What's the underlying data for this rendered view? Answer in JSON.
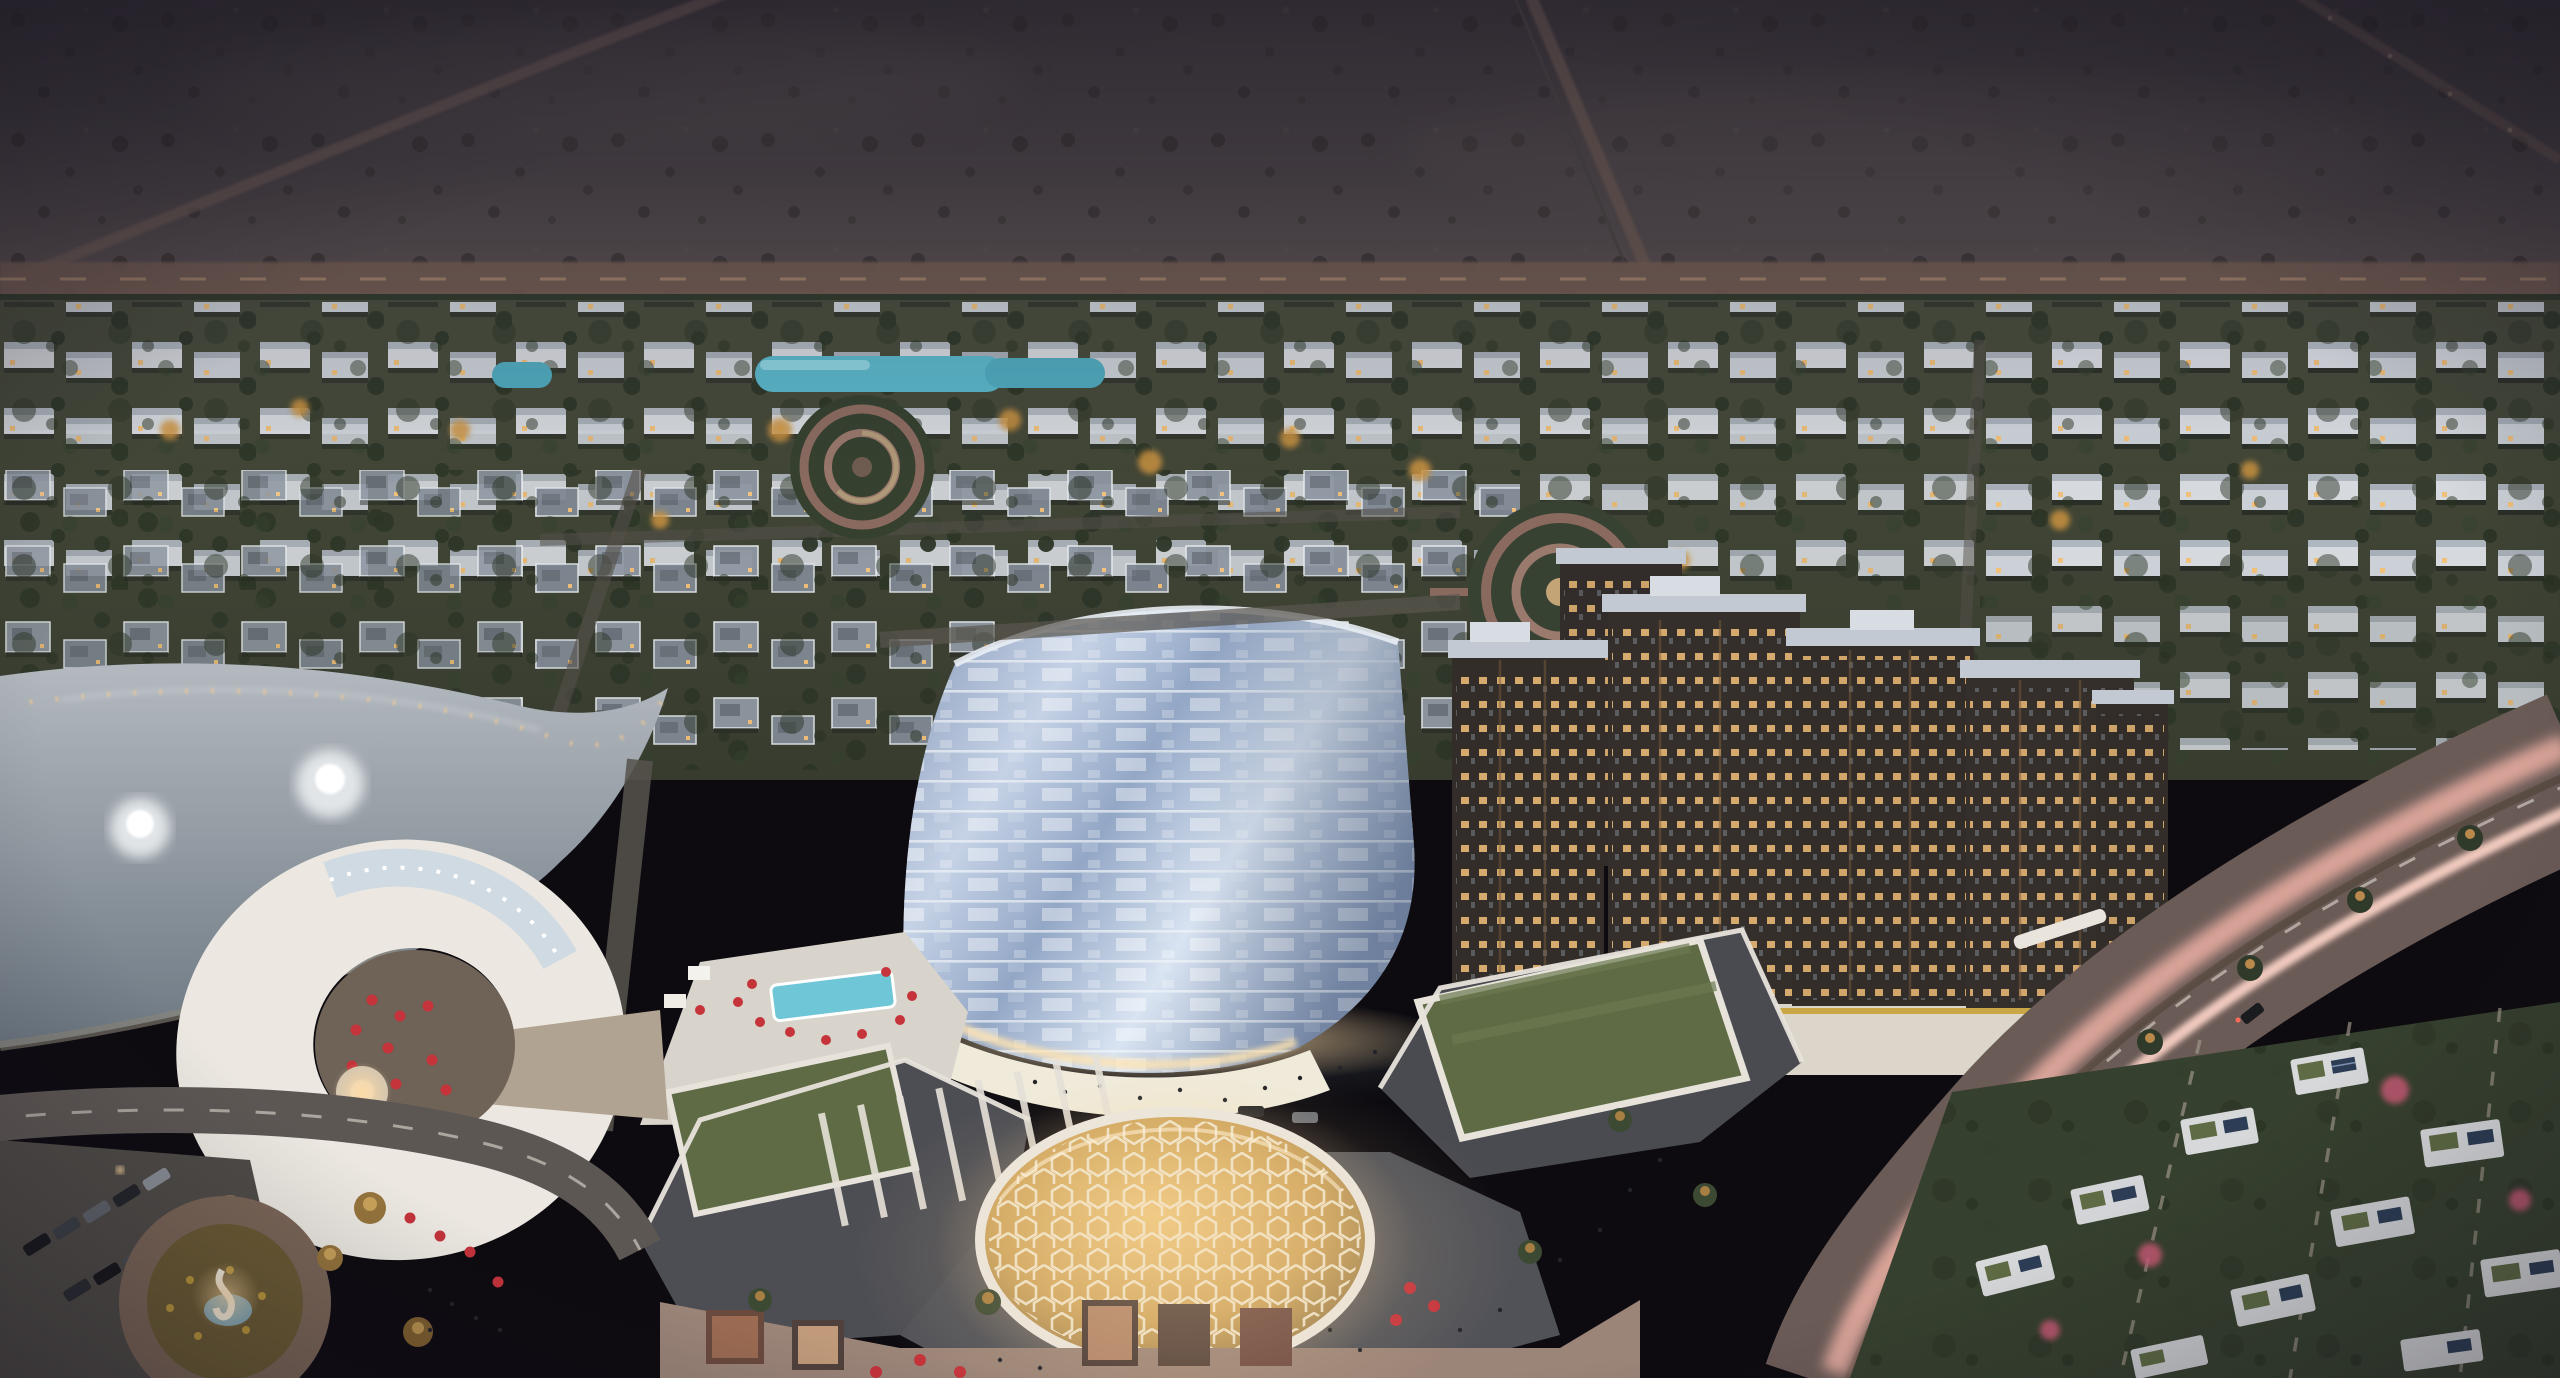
{
  "scene": {
    "type": "aerial-architectural-render",
    "time_of_day": "dusk",
    "setting": "desert master-planned residential community",
    "landmarks": [
      {
        "id": "desert-backdrop",
        "label": "empty desert plain with dirt roads"
      },
      {
        "id": "villa-district",
        "label": "rows of white and grey villas with lit windows"
      },
      {
        "id": "lagoon-pool",
        "label": "turquoise lagoon pool among villas"
      },
      {
        "id": "garden-circles",
        "label": "two circular spiral garden parks"
      },
      {
        "id": "lake",
        "label": "curved lake with two fountains and lit promenade"
      },
      {
        "id": "clubhouse",
        "label": "white C-shaped lakeside clubhouse with red umbrellas"
      },
      {
        "id": "hotel-tower",
        "label": "curved blue-glass hotel tower with lit plaza"
      },
      {
        "id": "pool-deck",
        "label": "hotel pool deck with red loungers"
      },
      {
        "id": "mall-complex",
        "label": "mall with glowing honeycomb dome and green roofs"
      },
      {
        "id": "apartment-complex",
        "label": "dark bronze apartment blocks on lit retail podium"
      },
      {
        "id": "parking-lot",
        "label": "parking lot with cars"
      },
      {
        "id": "roundabout",
        "label": "roundabout with flower bed and sculpture fountain"
      },
      {
        "id": "highway",
        "label": "curved highway with pink car light trails and palm median"
      },
      {
        "id": "townhouse-district",
        "label": "white townhouses with rooftop solar panels"
      }
    ],
    "features": {
      "fountains": 2,
      "garden_circles": 2,
      "domes": 1
    }
  },
  "palette": {
    "sky_top": "#343031",
    "sky_mid": "#454041",
    "horizon_haze": "#665750",
    "desert_speckle": "#26221e",
    "boundary_road": "#6f5a50",
    "villa_band": "#3f4336",
    "villa_white": "#d8dce1",
    "villa_grey": "#8e97a2",
    "tree_dark": "#2c3527",
    "tree_lit": "#c9923f",
    "lagoon": "#58b5c7",
    "lake_top": "#b3b9bf",
    "lake_deep": "#6d7882",
    "shore_light": "#f6c98e",
    "clubhouse_white": "#ece8e1",
    "terrace_taupe": "#6f6358",
    "umbrella_red": "#c5333b",
    "glass_light": "#d9e4f2",
    "glass_mid": "#93a7c6",
    "floor_line": "#f2f5f9",
    "hotel_glow": "#ffd9a0",
    "mall_roof": "#4d4e54",
    "parapet": "#e7e3db",
    "green_roof": "#5e6b44",
    "dome_gold": "#cfa65f",
    "dome_lattice": "#f2e9d4",
    "facade_taupe": "#9b8478",
    "apt_dark": "#322d2a",
    "apt_window": "#f1bd78",
    "apt_roof": "#c3c9d2",
    "podium": "#dcd5c9",
    "accent_gold": "#c7a239",
    "asphalt": "#5d5754",
    "highway": "#6b5b57",
    "light_trail": "#f4b5a8",
    "lane_dash": "#cfc8bf",
    "townhouse_white": "#d6d8da",
    "solar_blue": "#2c3d55",
    "bougainvillea": "#c75a74",
    "grass_dark": "#36402e",
    "palm_crown": "#96743c",
    "people_dark": "#23242a",
    "water_pool": "#6fc6d6",
    "sculpture_glow": "#e8dcc8",
    "vignette": "#15121d"
  }
}
